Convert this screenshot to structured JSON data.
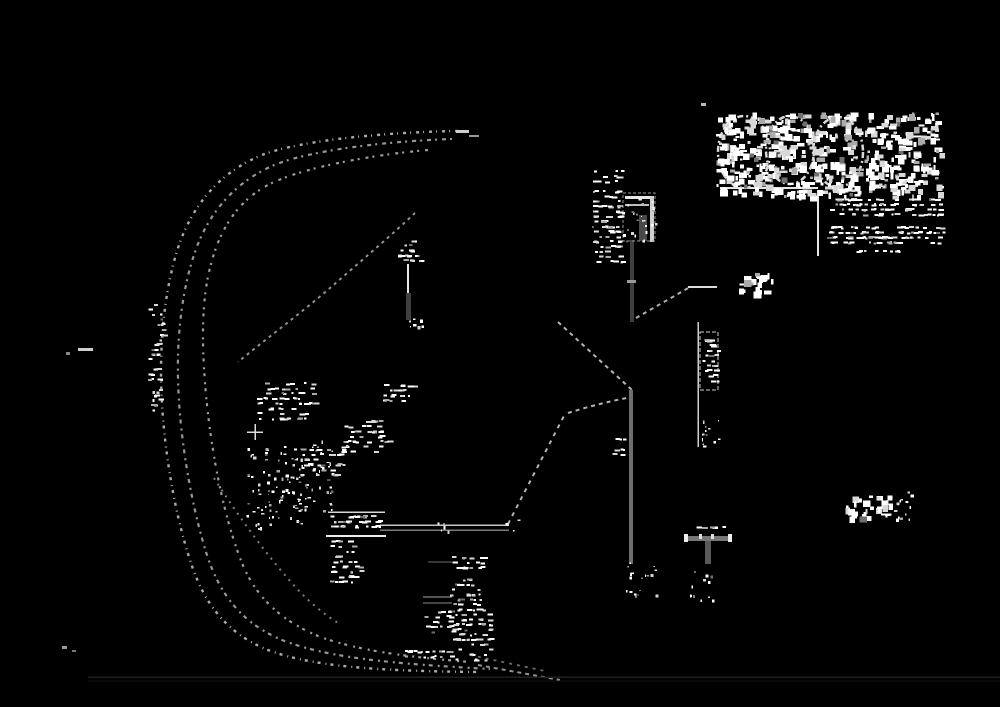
{
  "canvas": {
    "width": 1000,
    "height": 707,
    "background": "#000000"
  },
  "palette": {
    "ink": "#e2e2e2",
    "dim": "#9a9a9a",
    "dark_gray": "#3f3f3f",
    "mid_gray": "#6e6e6e",
    "faint_line": "#1c1c1c"
  },
  "scene": {
    "curves": [
      {
        "name": "road-edge-outer",
        "d": "M458,131 C390,132 300,140 262,155 C220,172 192,205 178,248 C166,285 161,330 161,372 C161,430 172,505 190,560 C204,605 228,634 268,650 C315,668 390,671 478,672",
        "dash": "3 5 1 4",
        "width": 2.4,
        "color": "#c9c9c9",
        "opacity": 0.85
      },
      {
        "name": "road-edge-middle",
        "d": "M452,139 C390,141 308,150 272,166 C232,184 206,216 193,258 C182,293 177,335 178,378 C179,432 190,500 206,552 C220,597 244,624 282,640 C330,659 400,664 490,669",
        "dash": "2 4 4 5",
        "width": 2.2,
        "color": "#bdbdbd",
        "opacity": 0.8
      },
      {
        "name": "road-edge-inner",
        "d": "M428,150 C370,155 300,168 268,185 C236,202 218,232 209,272 C201,307 202,350 206,395 C211,448 222,510 240,558 C254,596 280,620 318,636 C360,652 420,658 470,662",
        "dash": "3 6 2 4",
        "width": 2.2,
        "color": "#c4c4c4",
        "opacity": 0.8
      },
      {
        "name": "ramp-merge-upper",
        "d": "M415,213 C395,232 360,262 330,288 C300,314 262,342 238,362",
        "dash": "3 4",
        "width": 2,
        "color": "#b5b5b5",
        "opacity": 0.8
      },
      {
        "name": "ramp-merge-lower",
        "d": "M214,478 C238,516 270,560 300,592 C312,604 326,616 340,624",
        "dash": "2 5",
        "width": 2,
        "color": "#aaaaaa",
        "opacity": 0.75
      },
      {
        "name": "road-tail-1",
        "d": "M478,665 L560,680",
        "dash": "4 4",
        "width": 2,
        "color": "#b5b5b5",
        "opacity": 0.8
      },
      {
        "name": "road-tail-2",
        "d": "M470,655 L545,671",
        "dash": "3 5",
        "width": 1.8,
        "color": "#8d8d8d",
        "opacity": 0.75
      },
      {
        "name": "survey-chain-upper",
        "d": "M558,322 L632,390",
        "dash": "4 4",
        "width": 2,
        "color": "#c9c9c9",
        "opacity": 0.9
      },
      {
        "name": "survey-chain-horizontal",
        "d": "M568,413 C590,406 615,400 632,397",
        "dash": "4 4",
        "width": 2,
        "color": "#c9c9c9",
        "opacity": 0.9
      },
      {
        "name": "survey-chain-diagonal",
        "d": "M508,524 L566,412",
        "dash": "4 5",
        "width": 2,
        "color": "#c9c9c9",
        "opacity": 0.9
      },
      {
        "name": "survey-chain-short",
        "d": "M636,318 L690,287",
        "dash": "4 4",
        "width": 2,
        "color": "#c4c4c4",
        "opacity": 0.9
      }
    ],
    "lines": [
      {
        "name": "bearing-line-right",
        "x1": 688,
        "y1": 287,
        "x2": 717,
        "y2": 287,
        "color": "#dcdcdc",
        "width": 2
      },
      {
        "name": "logo-underline",
        "x1": 720,
        "y1": 188,
        "x2": 818,
        "y2": 188,
        "color": "#e6e6e6",
        "width": 2
      },
      {
        "name": "logo-drop-rule",
        "x1": 818,
        "y1": 190,
        "x2": 818,
        "y2": 256,
        "color": "#e6e6e6",
        "width": 2
      },
      {
        "name": "stone-label-top-rule",
        "x1": 328,
        "y1": 512,
        "x2": 385,
        "y2": 512,
        "color": "#d6d6d6",
        "width": 1.5
      },
      {
        "name": "stone-label-bottom-rule",
        "x1": 326,
        "y1": 536,
        "x2": 386,
        "y2": 536,
        "color": "#ececec",
        "width": 2
      },
      {
        "name": "leader-line-top",
        "x1": 380,
        "y1": 525,
        "x2": 509,
        "y2": 525,
        "color": "#c6c6c6",
        "width": 1.5
      },
      {
        "name": "leader-line-bottom",
        "x1": 380,
        "y1": 530,
        "x2": 509,
        "y2": 530,
        "color": "#7a7a7a",
        "width": 1.5
      },
      {
        "name": "stack-rule-1",
        "x1": 423,
        "y1": 597,
        "x2": 452,
        "y2": 597,
        "color": "#a8a8a8",
        "width": 1
      },
      {
        "name": "stack-rule-2",
        "x1": 423,
        "y1": 603,
        "x2": 452,
        "y2": 603,
        "color": "#8a8a8a",
        "width": 1
      },
      {
        "name": "stack-rule-3",
        "x1": 428,
        "y1": 562,
        "x2": 452,
        "y2": 562,
        "color": "#6a6a6a",
        "width": 1
      },
      {
        "name": "cross-mark-horizontal",
        "x1": 247,
        "y1": 432,
        "x2": 263,
        "y2": 432,
        "color": "#dddddd",
        "width": 1.5
      },
      {
        "name": "cross-mark-vertical",
        "x1": 255,
        "y1": 424,
        "x2": 255,
        "y2": 440,
        "color": "#dddddd",
        "width": 1.5
      },
      {
        "name": "pin-line-white",
        "x1": 408,
        "y1": 264,
        "x2": 408,
        "y2": 293,
        "color": "#e8e8e8",
        "width": 2
      },
      {
        "name": "ladder-spine",
        "x1": 698,
        "y1": 322,
        "x2": 698,
        "y2": 447,
        "color": "#cfcfcf",
        "width": 1.5
      },
      {
        "name": "bottom-faint-rule-1",
        "x1": 88,
        "y1": 677,
        "x2": 1000,
        "y2": 677,
        "color": "#1f1f1f",
        "width": 1.5
      },
      {
        "name": "bottom-faint-rule-2",
        "x1": 88,
        "y1": 681,
        "x2": 1000,
        "y2": 681,
        "color": "#141414",
        "width": 1
      }
    ],
    "bars": [
      {
        "name": "boundary-post-gray",
        "x": 630,
        "y": 240,
        "w": 4,
        "h": 82,
        "color": "#3f3f3f"
      },
      {
        "name": "boundary-post-tick",
        "x": 627,
        "y": 280,
        "w": 9,
        "h": 3,
        "color": "#9a9a9a"
      },
      {
        "name": "pin-line-gray",
        "x": 406,
        "y": 293,
        "w": 5,
        "h": 27,
        "color": "#3f3f3f"
      },
      {
        "name": "monument-box-bar-top",
        "x": 625,
        "y": 196,
        "w": 28,
        "h": 3,
        "color": "#e8e8e8"
      },
      {
        "name": "monument-box-bar-mid",
        "x": 625,
        "y": 204,
        "w": 24,
        "h": 2,
        "color": "#bdbdbd"
      },
      {
        "name": "monument-box-gray-core",
        "x": 639,
        "y": 215,
        "w": 8,
        "h": 26,
        "color": "#4a4a4a"
      },
      {
        "name": "monument-box-right-strip",
        "x": 650,
        "y": 196,
        "w": 4,
        "h": 46,
        "color": "#cfcfcf"
      },
      {
        "name": "property-line-gray",
        "x": 629,
        "y": 390,
        "w": 4,
        "h": 174,
        "color": "#6e6e6e"
      },
      {
        "name": "t-monument-crossbar",
        "x": 686,
        "y": 536,
        "w": 44,
        "h": 5,
        "color": "#777777"
      },
      {
        "name": "t-monument-cap-left",
        "x": 684,
        "y": 534,
        "w": 4,
        "h": 8,
        "color": "#eeeeee"
      },
      {
        "name": "t-monument-cap-right",
        "x": 728,
        "y": 534,
        "w": 4,
        "h": 8,
        "color": "#eeeeee"
      },
      {
        "name": "t-monument-tick-1",
        "x": 699,
        "y": 534,
        "w": 3,
        "h": 5,
        "color": "#dddddd"
      },
      {
        "name": "t-monument-tick-2",
        "x": 711,
        "y": 534,
        "w": 3,
        "h": 5,
        "color": "#dddddd"
      },
      {
        "name": "t-monument-stem",
        "x": 705,
        "y": 541,
        "w": 6,
        "h": 23,
        "color": "#5a5a5a"
      },
      {
        "name": "curve-start-tick-1",
        "x": 456,
        "y": 130,
        "w": 13,
        "h": 3,
        "color": "#cfcfcf"
      },
      {
        "name": "curve-start-tick-2",
        "x": 469,
        "y": 135,
        "w": 10,
        "h": 2,
        "color": "#9a9a9a"
      },
      {
        "name": "logo-corner-tick",
        "x": 701,
        "y": 103,
        "w": 5,
        "h": 3,
        "color": "#bbbbbb"
      },
      {
        "name": "left-margin-dash",
        "x": 78,
        "y": 348,
        "w": 15,
        "h": 3,
        "color": "#cfcfcf"
      },
      {
        "name": "left-margin-dot",
        "x": 66,
        "y": 352,
        "w": 4,
        "h": 3,
        "color": "#888888"
      },
      {
        "name": "bottom-left-dot-1",
        "x": 62,
        "y": 646,
        "w": 5,
        "h": 3,
        "color": "#9a9a9a"
      },
      {
        "name": "bottom-left-dot-2",
        "x": 72,
        "y": 650,
        "w": 4,
        "h": 2,
        "color": "#777777"
      }
    ],
    "outlines": [
      {
        "name": "ladder-box-outline",
        "x": 700,
        "y": 332,
        "w": 18,
        "h": 58,
        "color": "#cfcfcf",
        "width": 1.2,
        "dash": "4 2"
      },
      {
        "name": "monument-box-outline",
        "x": 623,
        "y": 193,
        "w": 32,
        "h": 48,
        "color": "#9a9a9a",
        "width": 1,
        "dash": "3 2"
      }
    ],
    "ellipses": [
      {
        "name": "logo-letter-outline-1",
        "cx": 744,
        "cy": 152,
        "rx": 26,
        "ry": 36
      },
      {
        "name": "logo-letter-outline-2",
        "cx": 790,
        "cy": 150,
        "rx": 24,
        "ry": 34
      },
      {
        "name": "logo-letter-outline-3",
        "cx": 838,
        "cy": 152,
        "rx": 25,
        "ry": 35
      }
    ],
    "ellipse_style": {
      "color": "#d9d9d9",
      "width": 2.5,
      "dash": "6 3 2 3"
    },
    "noise": [
      {
        "name": "logo-glyph-noise-1",
        "x": 716,
        "y": 112,
        "w": 142,
        "h": 84,
        "density": 0.5,
        "mode": "glyph",
        "seed": 11
      },
      {
        "name": "logo-glyph-noise-2",
        "x": 864,
        "y": 112,
        "w": 74,
        "h": 40,
        "density": 0.45,
        "mode": "glyph",
        "seed": 12
      },
      {
        "name": "logo-glyph-noise-3",
        "x": 864,
        "y": 152,
        "w": 76,
        "h": 44,
        "density": 0.45,
        "mode": "glyph",
        "seed": 13
      },
      {
        "name": "address-text-row-1",
        "x": 828,
        "y": 198,
        "w": 112,
        "h": 22,
        "density": 0.5,
        "mode": "text",
        "seed": 14
      },
      {
        "name": "address-text-row-2",
        "x": 826,
        "y": 226,
        "w": 118,
        "h": 24,
        "density": 0.5,
        "mode": "text",
        "seed": 15
      },
      {
        "name": "address-dashes",
        "x": 856,
        "y": 250,
        "w": 50,
        "h": 5,
        "density": 0.55,
        "mode": "text",
        "seed": 16
      },
      {
        "name": "pole-text-column",
        "x": 592,
        "y": 170,
        "w": 30,
        "h": 95,
        "density": 0.45,
        "mode": "text",
        "seed": 17
      },
      {
        "name": "monument-box-speckle",
        "x": 622,
        "y": 192,
        "w": 34,
        "h": 50,
        "density": 0.3,
        "mode": "speckle",
        "seed": 18
      },
      {
        "name": "bearing-label-28",
        "x": 737,
        "y": 272,
        "w": 36,
        "h": 20,
        "density": 0.5,
        "mode": "glyph",
        "seed": 19
      },
      {
        "name": "ladder-rung-text",
        "x": 702,
        "y": 334,
        "w": 15,
        "h": 54,
        "density": 0.5,
        "mode": "text",
        "seed": 20
      },
      {
        "name": "ladder-foot-bracket",
        "x": 699,
        "y": 418,
        "w": 20,
        "h": 30,
        "density": 0.4,
        "mode": "speckle",
        "seed": 21
      },
      {
        "name": "property-line-side-text",
        "x": 612,
        "y": 438,
        "w": 12,
        "h": 22,
        "density": 0.45,
        "mode": "text",
        "seed": 22
      },
      {
        "name": "property-line-foot-scatter",
        "x": 625,
        "y": 562,
        "w": 32,
        "h": 34,
        "density": 0.35,
        "mode": "speckle",
        "seed": 23
      },
      {
        "name": "t-monument-foot-scatter",
        "x": 688,
        "y": 566,
        "w": 24,
        "h": 34,
        "density": 0.3,
        "mode": "speckle",
        "seed": 24
      },
      {
        "name": "t-monument-top-dashes",
        "x": 696,
        "y": 526,
        "w": 30,
        "h": 6,
        "density": 0.5,
        "mode": "text",
        "seed": 25
      },
      {
        "name": "scale-char-1",
        "x": 843,
        "y": 495,
        "w": 12,
        "h": 22,
        "density": 0.55,
        "mode": "glyph",
        "seed": 26
      },
      {
        "name": "scale-char-2",
        "x": 858,
        "y": 495,
        "w": 13,
        "h": 22,
        "density": 0.55,
        "mode": "glyph",
        "seed": 27
      },
      {
        "name": "scale-char-3",
        "x": 876,
        "y": 495,
        "w": 14,
        "h": 22,
        "density": 0.55,
        "mode": "glyph",
        "seed": 28
      },
      {
        "name": "scale-scribble",
        "x": 893,
        "y": 486,
        "w": 18,
        "h": 33,
        "density": 0.5,
        "mode": "speckle",
        "seed": 29
      },
      {
        "name": "scale-underline",
        "x": 874,
        "y": 513,
        "w": 20,
        "h": 4,
        "density": 0.6,
        "mode": "text",
        "seed": 30
      },
      {
        "name": "stone-label-text",
        "x": 330,
        "y": 515,
        "w": 52,
        "h": 19,
        "density": 0.6,
        "mode": "text",
        "seed": 31
      },
      {
        "name": "stone-label-column",
        "x": 330,
        "y": 540,
        "w": 30,
        "h": 46,
        "density": 0.4,
        "mode": "text",
        "seed": 32
      },
      {
        "name": "brush-blob-left",
        "x": 246,
        "y": 448,
        "w": 60,
        "h": 80,
        "density": 0.3,
        "mode": "speckle",
        "seed": 33
      },
      {
        "name": "brush-blob-right",
        "x": 280,
        "y": 440,
        "w": 54,
        "h": 70,
        "density": 0.3,
        "mode": "speckle",
        "seed": 34
      },
      {
        "name": "mid-annotation-1",
        "x": 256,
        "y": 382,
        "w": 62,
        "h": 40,
        "density": 0.35,
        "mode": "text",
        "seed": 35
      },
      {
        "name": "mid-annotation-2",
        "x": 383,
        "y": 384,
        "w": 32,
        "h": 24,
        "density": 0.4,
        "mode": "text",
        "seed": 36
      },
      {
        "name": "mid-annotation-3",
        "x": 340,
        "y": 420,
        "w": 52,
        "h": 36,
        "density": 0.35,
        "mode": "text",
        "seed": 37
      },
      {
        "name": "mid-annotation-4",
        "x": 300,
        "y": 448,
        "w": 46,
        "h": 30,
        "density": 0.3,
        "mode": "text",
        "seed": 38
      },
      {
        "name": "leader-arrow-blob",
        "x": 436,
        "y": 522,
        "w": 14,
        "h": 11,
        "density": 0.6,
        "mode": "speckle",
        "seed": 39
      },
      {
        "name": "bottom-stack-row-1",
        "x": 452,
        "y": 556,
        "w": 34,
        "h": 18,
        "density": 0.45,
        "mode": "text",
        "seed": 40
      },
      {
        "name": "bottom-stack-row-2",
        "x": 448,
        "y": 578,
        "w": 32,
        "h": 30,
        "density": 0.4,
        "mode": "text",
        "seed": 41
      },
      {
        "name": "bottom-stack-row-3",
        "x": 424,
        "y": 610,
        "w": 28,
        "h": 28,
        "density": 0.4,
        "mode": "text",
        "seed": 42
      },
      {
        "name": "bottom-stack-row-4",
        "x": 452,
        "y": 608,
        "w": 38,
        "h": 56,
        "density": 0.42,
        "mode": "text",
        "seed": 43
      },
      {
        "name": "bottom-dash-row",
        "x": 400,
        "y": 650,
        "w": 52,
        "h": 10,
        "density": 0.5,
        "mode": "text",
        "seed": 44
      },
      {
        "name": "left-edge-column",
        "x": 148,
        "y": 298,
        "w": 14,
        "h": 118,
        "density": 0.3,
        "mode": "text",
        "seed": 45
      },
      {
        "name": "left-bracket-mark",
        "x": 150,
        "y": 390,
        "w": 10,
        "h": 20,
        "density": 0.4,
        "mode": "speckle",
        "seed": 46
      },
      {
        "name": "pin-top-noise",
        "x": 397,
        "y": 239,
        "w": 28,
        "h": 26,
        "density": 0.4,
        "mode": "text",
        "seed": 47
      },
      {
        "name": "pin-foot-noise",
        "x": 399,
        "y": 317,
        "w": 24,
        "h": 14,
        "density": 0.4,
        "mode": "speckle",
        "seed": 48
      },
      {
        "name": "chain-junction-noise",
        "x": 505,
        "y": 518,
        "w": 14,
        "h": 14,
        "density": 0.4,
        "mode": "speckle",
        "seed": 49
      }
    ]
  }
}
